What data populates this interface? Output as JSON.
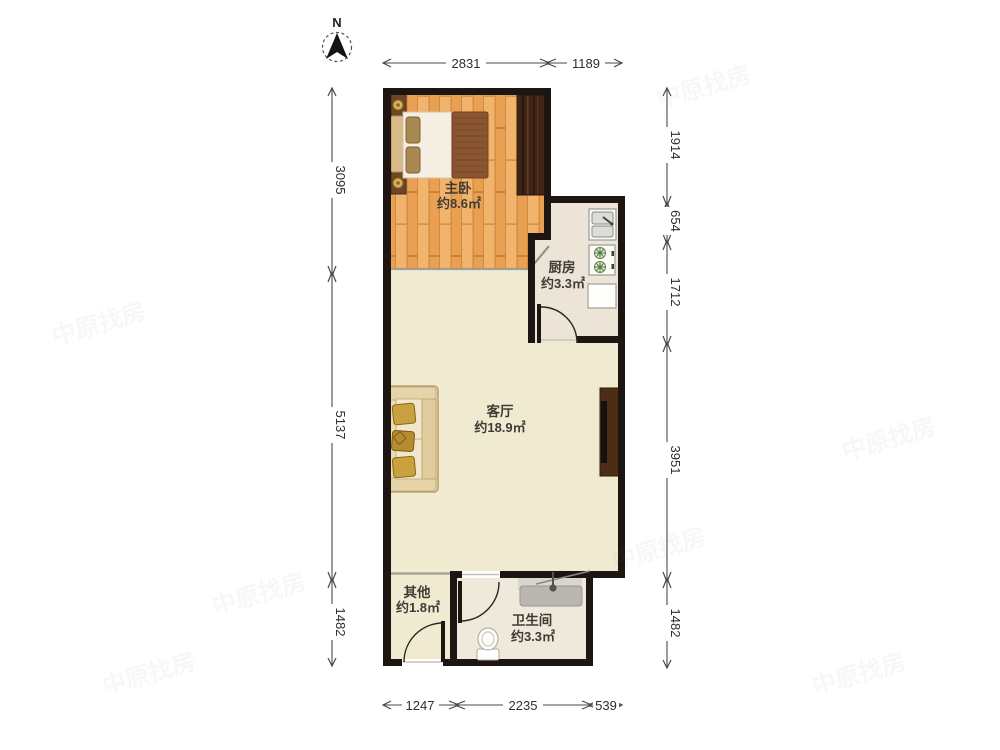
{
  "compass": {
    "label": "N"
  },
  "rooms": {
    "bedroom": {
      "name": "主卧",
      "area": "约8.6㎡"
    },
    "kitchen": {
      "name": "厨房",
      "area": "约3.3㎡"
    },
    "living": {
      "name": "客厅",
      "area": "约18.9㎡"
    },
    "other": {
      "name": "其他",
      "area": "约1.8㎡"
    },
    "bathroom": {
      "name": "卫生间",
      "area": "约3.3㎡"
    }
  },
  "dimensions": {
    "top": [
      "2831",
      "1189"
    ],
    "left": [
      "3095",
      "5137",
      "1482"
    ],
    "right": [
      "1914",
      "654",
      "1712",
      "3951",
      "1482"
    ],
    "bottom": [
      "1247",
      "2235",
      "539"
    ]
  },
  "watermark": {
    "text": "中原找房"
  },
  "palette": {
    "wall": "#1c1511",
    "wood": "#efab61",
    "wood_line": "#cf8a40",
    "floor_living": "#f0ebd0",
    "floor_kitchen": "#ece4d6",
    "floor_bath": "#efe9db",
    "wardrobe": "#3f2416",
    "dim": "#4a4a4a",
    "label": "#3f3c38"
  }
}
